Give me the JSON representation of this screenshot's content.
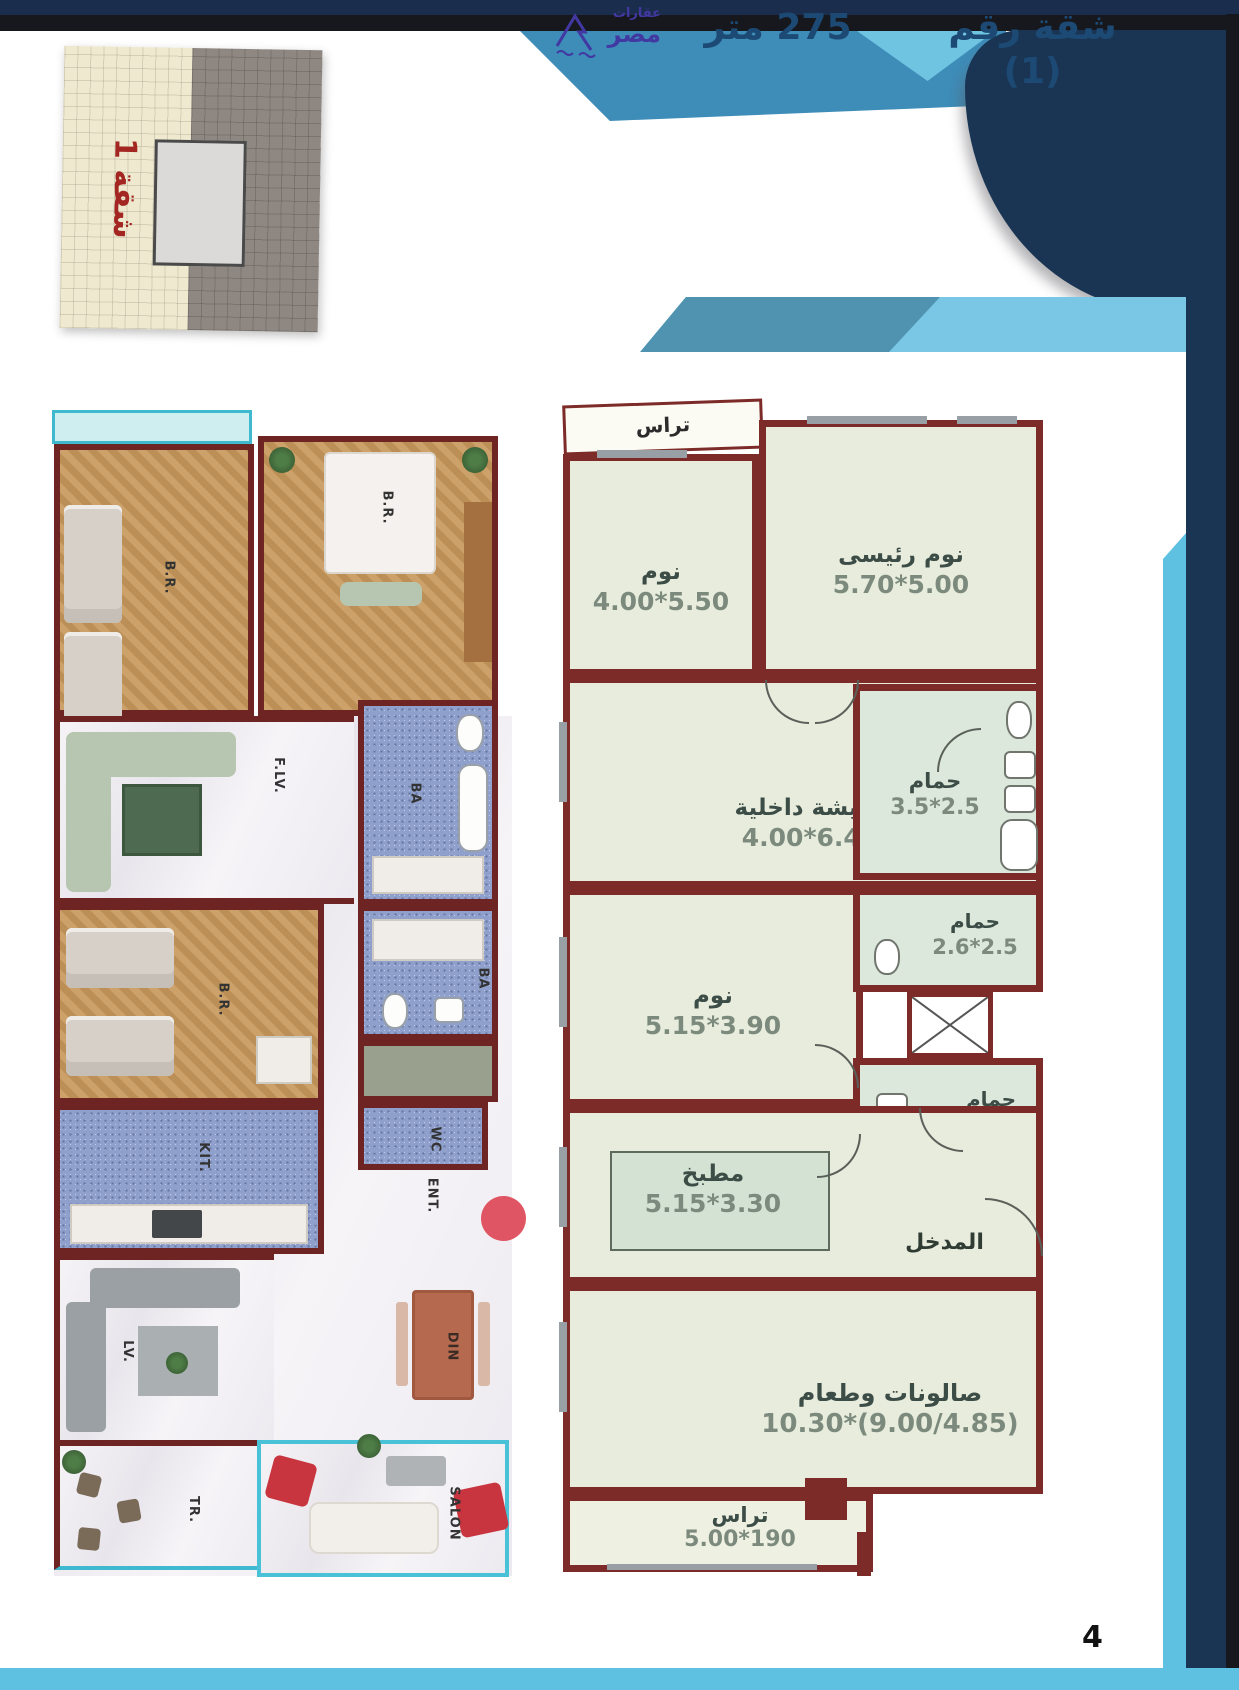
{
  "page": {
    "number": "4"
  },
  "logo": {
    "word1": "عقارات",
    "word2": "مصر"
  },
  "header": {
    "title_apartment": "شقة رقم (1)",
    "title_area": "275 متر"
  },
  "thumbnail": {
    "label": "شقة 1"
  },
  "plan2d": {
    "rooms": [
      {
        "name": "تراس",
        "dims": ""
      },
      {
        "name": "نوم",
        "dims": "4.00*5.50"
      },
      {
        "name": "نوم رئيسى",
        "dims": "5.70*5.00"
      },
      {
        "name": "معيشة داخلية",
        "dims": "4.00*6.40"
      },
      {
        "name": "حمام",
        "dims": "3.5*2.5"
      },
      {
        "name": "نوم",
        "dims": "5.15*3.90"
      },
      {
        "name": "حمام",
        "dims": "2.6*2.5"
      },
      {
        "name": "حمام ضيوف",
        "dims": ""
      },
      {
        "name": "مطبخ",
        "dims": "5.15*3.30"
      },
      {
        "name": "المدخل",
        "dims": ""
      },
      {
        "name": "صالونات وطعام",
        "dims": "10.30*(9.00/4.85)"
      },
      {
        "name": "تراس",
        "dims": "5.00*190"
      }
    ]
  },
  "plan3d": {
    "labels": {
      "br_top_left": "B.R.",
      "br_top_right": "B.R.",
      "family_living": "F.LV.",
      "bath_a": "BA",
      "bath_b": "BA",
      "br_mid": "B.R.",
      "wc": "WC",
      "kitchen": "KIT.",
      "living": "LV.",
      "dining": "DIN",
      "entrance": "ENT.",
      "terrace": "TR.",
      "salon": "SALON"
    }
  },
  "colors": {
    "navy": "#1a3553",
    "black_strip": "#17181d",
    "teal_band": "#3e8cb8",
    "light_triangle": "#6fc4e2",
    "banner_light": "#7ac6e5",
    "banner_dark": "#4f93b0",
    "banner_text": "#1c4a75",
    "bottom_bar": "#5fc1e1",
    "wall_maroon": "#7c2b28",
    "room_fill": "#e7ecdc",
    "red_marker": "#e05563",
    "thumb_label_red": "#a32622",
    "logo_purple": "#4238a2"
  }
}
